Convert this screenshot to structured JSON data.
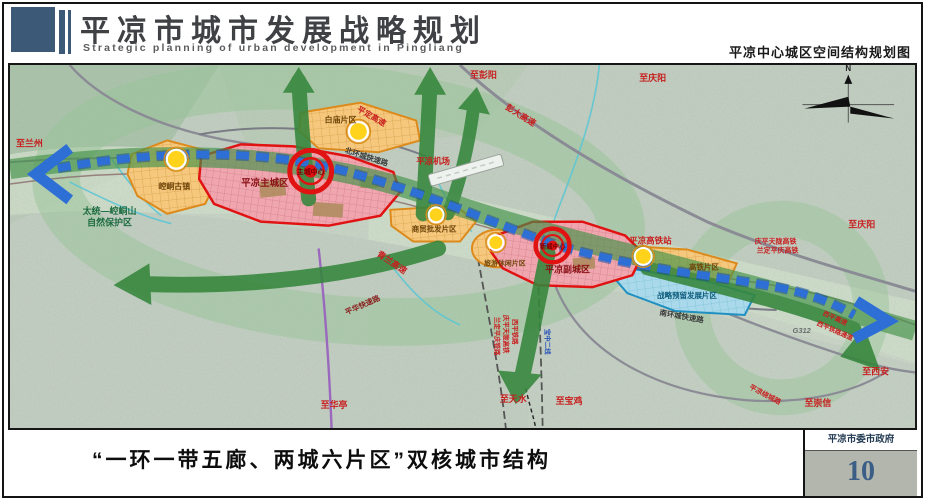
{
  "header": {
    "title_cn": "平凉市城市发展战略规划",
    "title_en": "Strategic planning of urban development in Pingliang",
    "subtitle_right": "平凉中心城区空间结构规划图"
  },
  "footer": {
    "caption": "“一环一带五廊、两城六片区”双核城市结构",
    "agency": "平凉市委市政府",
    "page_number": "10"
  },
  "map": {
    "compass": "N",
    "zones": {
      "kongtong_town": "崆峒古镇",
      "baimiao": "白庙片区",
      "main_city": "平凉主城区",
      "main_center": "主城中心",
      "wholesale": "商贸批发片区",
      "leisure": "旅游休闲片区",
      "sub_city": "平凉副城区",
      "new_center": "新城中心",
      "hsr_district": "高铁片区",
      "strategic_reserve": "战略预留发展片区"
    },
    "labels": {
      "to_lanzhou": "至兰州",
      "to_pengyang": "至彭阳",
      "to_qingyang_top": "至庆阳",
      "to_qingyang_right": "至庆阳",
      "pengda_expressway": "彭大高速",
      "pingding_expressway": "平定高速",
      "north_ring_road": "北环城快速路",
      "pingliang_airport": "平凉机场",
      "qinglan_expressway": "青兰高速",
      "nature_reserve_line1": "太统—崆峒山",
      "nature_reserve_line2": "自然保护区",
      "hsr_station": "平凉高铁站",
      "qingping_tianlong_hsr": "庆平天陇高铁",
      "landing_pingqing_hsr": "兰定平庆高铁",
      "south_ring_road": "南环城快速路",
      "pinghua_expressway": "平华快速路",
      "xiping_railway": "西平铁路",
      "qingping_tianlong_hsr_v": "庆平天陇高铁",
      "landing_pingqing_railway_v": "兰定平庆铁路",
      "baozhong_line2": "宝中二线",
      "to_huating": "至华亭",
      "to_tianshui": "至天水",
      "to_baoji": "至宝鸡",
      "g312": "G312",
      "xiping_expressway": "西平高速",
      "xiping_rail_corridor": "西平铁路通道",
      "ring_expressway": "平凉绕城路",
      "to_chongxin": "至崇信",
      "to_xian": "至西安"
    },
    "colors": {
      "header_accent": "#3c5a78",
      "corridor_green": "#35863c",
      "belt_blue": "#2e6fd6",
      "city_zone_red": "#e01212",
      "district_orange": "#dd8a1c",
      "reserve_blue": "#2090c0",
      "page_number_blue": "#3a5e86",
      "label_red": "#c81e1e"
    }
  }
}
